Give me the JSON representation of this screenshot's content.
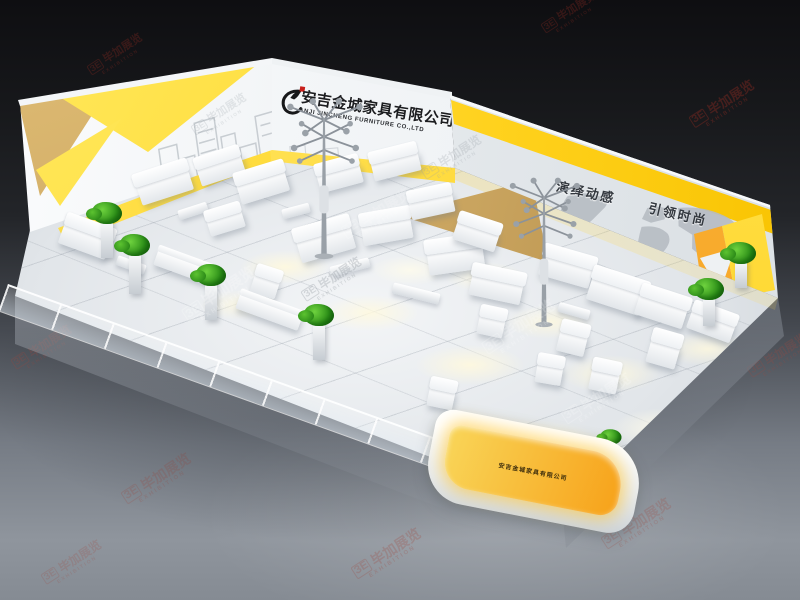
{
  "scene": {
    "company_cn": "安吉金城家具有限公司",
    "company_en": "ANJI JINCHENG FURNITURE CO.,LTD",
    "slogan_1": "演绎动感",
    "slogan_2": "引领时尚",
    "desk_text": "安吉金城家具有限公司"
  },
  "colors": {
    "accent_yellow": "#ffd21e",
    "accent_orange": "#f7a21a",
    "wood": "#c9a45f",
    "watermark_red": "#8f2b22",
    "wall_white": "#f4f6f8",
    "floor_gray": "#e2e5e9"
  },
  "watermarks": {
    "mark": "ЗE",
    "text": "毕加展览",
    "sub": "EXHIBITION",
    "instances": [
      {
        "x": 30,
        "y": 135,
        "r": -33,
        "s": 13,
        "o": 0.38,
        "l": "bg",
        "c": "#8f2b22"
      },
      {
        "x": 86,
        "y": 48,
        "r": -33,
        "s": 11,
        "o": 0.3,
        "l": "bg",
        "c": "#8f2b22"
      },
      {
        "x": 540,
        "y": 6,
        "r": -33,
        "s": 11,
        "o": 0.3,
        "l": "bg",
        "c": "#8f2b22"
      },
      {
        "x": 688,
        "y": 96,
        "r": -33,
        "s": 13,
        "o": 0.4,
        "l": "bg",
        "c": "#8f2b22"
      },
      {
        "x": 10,
        "y": 340,
        "r": -33,
        "s": 12,
        "o": 0.28,
        "l": "bg",
        "c": "#a0493f"
      },
      {
        "x": 746,
        "y": 348,
        "r": -33,
        "s": 12,
        "o": 0.25,
        "l": "bg",
        "c": "#a0493f"
      },
      {
        "x": 120,
        "y": 470,
        "r": -33,
        "s": 14,
        "o": 0.22,
        "l": "bg",
        "c": "#a0493f"
      },
      {
        "x": 350,
        "y": 545,
        "r": -33,
        "s": 14,
        "o": 0.25,
        "l": "bg",
        "c": "#a0493f"
      },
      {
        "x": 600,
        "y": 515,
        "r": -33,
        "s": 14,
        "o": 0.22,
        "l": "bg",
        "c": "#a0493f"
      },
      {
        "x": 40,
        "y": 555,
        "r": -33,
        "s": 12,
        "o": 0.2,
        "l": "bg",
        "c": "#a0493f"
      },
      {
        "x": 180,
        "y": 285,
        "r": -33,
        "s": 15,
        "o": 0.22,
        "l": "fg",
        "c": "#ffffff"
      },
      {
        "x": 340,
        "y": 205,
        "r": -33,
        "s": 14,
        "o": 0.18,
        "l": "fg",
        "c": "#ffffff"
      },
      {
        "x": 480,
        "y": 318,
        "r": -33,
        "s": 15,
        "o": 0.2,
        "l": "fg",
        "c": "#ffffff"
      },
      {
        "x": 420,
        "y": 150,
        "r": -33,
        "s": 12,
        "o": 0.25,
        "l": "fg",
        "c": "#9aa1a8"
      },
      {
        "x": 300,
        "y": 272,
        "r": -33,
        "s": 12,
        "o": 0.3,
        "l": "fg",
        "c": "#8b9299"
      },
      {
        "x": 560,
        "y": 390,
        "r": -33,
        "s": 14,
        "o": 0.2,
        "l": "fg",
        "c": "#ffffff"
      },
      {
        "x": 190,
        "y": 108,
        "r": -33,
        "s": 11,
        "o": 0.22,
        "l": "fg",
        "c": "#9aa1a8"
      }
    ]
  },
  "furniture": [
    {
      "t": "sofa",
      "x": 138,
      "y": 176,
      "w": 54,
      "h": 22,
      "r": -18
    },
    {
      "t": "sofa",
      "x": 198,
      "y": 160,
      "w": 46,
      "h": 20,
      "r": -18
    },
    {
      "t": "table",
      "x": 178,
      "y": 206,
      "w": 30,
      "h": 10,
      "r": -18
    },
    {
      "t": "sofa",
      "x": 238,
      "y": 176,
      "w": 50,
      "h": 22,
      "r": -17
    },
    {
      "t": "sofa",
      "x": 208,
      "y": 214,
      "w": 36,
      "h": 18,
      "r": -17
    },
    {
      "t": "table",
      "x": 282,
      "y": 206,
      "w": 28,
      "h": 10,
      "r": -15
    },
    {
      "t": "sofa",
      "x": 318,
      "y": 168,
      "w": 44,
      "h": 20,
      "r": -15
    },
    {
      "t": "sofa",
      "x": 372,
      "y": 156,
      "w": 48,
      "h": 20,
      "r": -14
    },
    {
      "t": "sofa",
      "x": 298,
      "y": 232,
      "w": 56,
      "h": 24,
      "r": -16
    },
    {
      "t": "sofa",
      "x": 362,
      "y": 220,
      "w": 50,
      "h": 22,
      "r": -10
    },
    {
      "t": "bench",
      "x": 330,
      "y": 262,
      "w": 40,
      "h": 10,
      "r": -14
    },
    {
      "t": "sofa",
      "x": 410,
      "y": 196,
      "w": 44,
      "h": 20,
      "r": -12
    },
    {
      "t": "sofa",
      "x": 428,
      "y": 248,
      "w": 56,
      "h": 24,
      "r": -8
    },
    {
      "t": "bench",
      "x": 392,
      "y": 288,
      "w": 48,
      "h": 11,
      "r": 14
    },
    {
      "t": "sofa",
      "x": 454,
      "y": 226,
      "w": 44,
      "h": 20,
      "r": 18
    },
    {
      "t": "sofa",
      "x": 470,
      "y": 278,
      "w": 52,
      "h": 22,
      "r": 12
    },
    {
      "t": "armchair",
      "x": 478,
      "y": 316,
      "w": 26,
      "h": 20,
      "r": 12
    },
    {
      "t": "sofa",
      "x": 540,
      "y": 260,
      "w": 52,
      "h": 22,
      "r": 16
    },
    {
      "t": "sofa",
      "x": 588,
      "y": 284,
      "w": 56,
      "h": 24,
      "r": 18
    },
    {
      "t": "table",
      "x": 558,
      "y": 306,
      "w": 32,
      "h": 10,
      "r": 16
    },
    {
      "t": "armchair",
      "x": 558,
      "y": 332,
      "w": 28,
      "h": 22,
      "r": 14
    },
    {
      "t": "sofa",
      "x": 636,
      "y": 300,
      "w": 50,
      "h": 22,
      "r": 18
    },
    {
      "t": "armchair",
      "x": 648,
      "y": 342,
      "w": 30,
      "h": 24,
      "r": 16
    },
    {
      "t": "sofa",
      "x": 688,
      "y": 316,
      "w": 46,
      "h": 20,
      "r": 20
    },
    {
      "t": "armchair",
      "x": 590,
      "y": 370,
      "w": 28,
      "h": 22,
      "r": 12
    },
    {
      "t": "armchair",
      "x": 536,
      "y": 364,
      "w": 26,
      "h": 20,
      "r": 10
    },
    {
      "t": "counter",
      "x": 154,
      "y": 260,
      "w": 64,
      "h": 16,
      "r": 20
    },
    {
      "t": "armchair",
      "x": 252,
      "y": 276,
      "w": 26,
      "h": 20,
      "r": 18
    },
    {
      "t": "counter",
      "x": 236,
      "y": 304,
      "w": 66,
      "h": 16,
      "r": 20
    },
    {
      "t": "sofa",
      "x": 60,
      "y": 230,
      "w": 50,
      "h": 22,
      "r": 20
    },
    {
      "t": "table",
      "x": 116,
      "y": 260,
      "w": 30,
      "h": 10,
      "r": 20
    },
    {
      "t": "armchair",
      "x": 428,
      "y": 388,
      "w": 26,
      "h": 20,
      "r": 12
    }
  ]
}
